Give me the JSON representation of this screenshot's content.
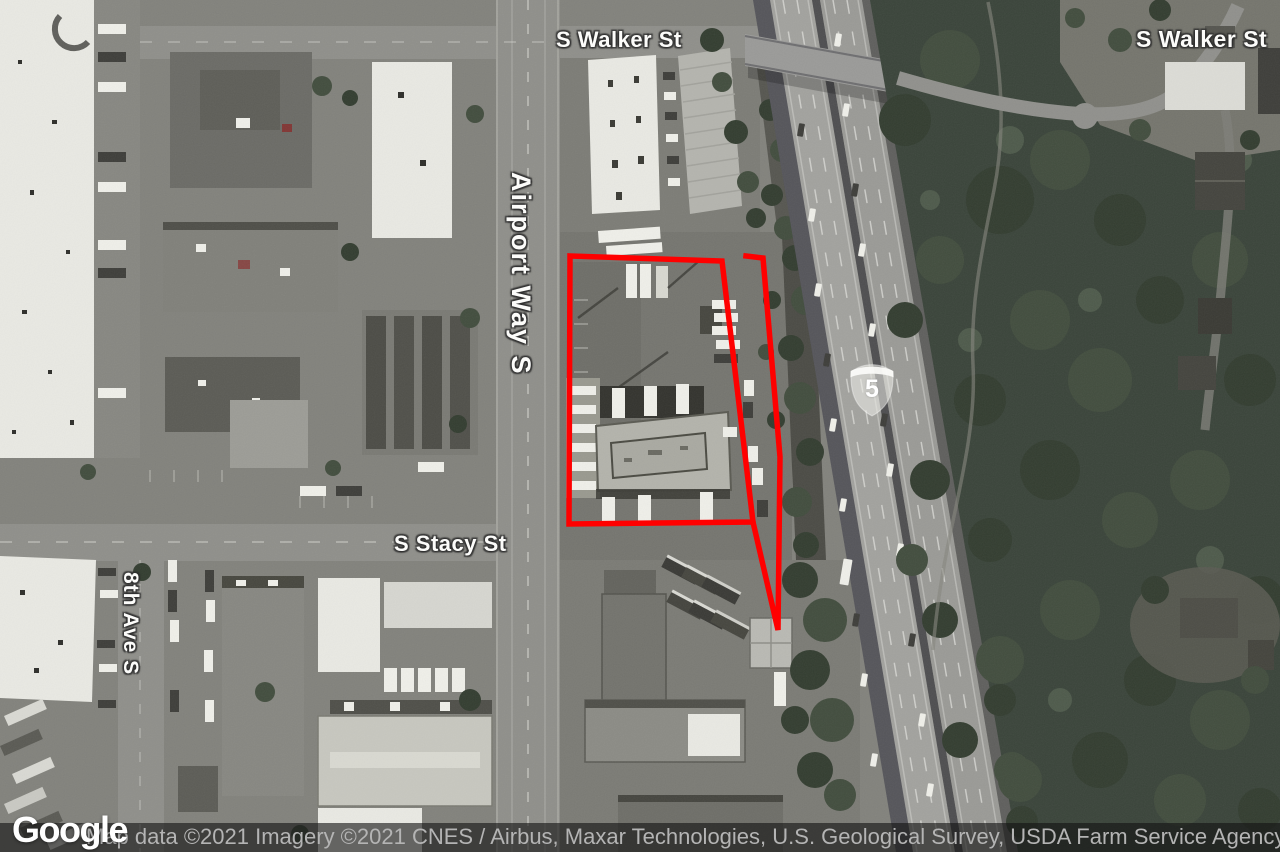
{
  "map": {
    "road_labels": {
      "walker_west": "S Walker St",
      "walker_east": "S Walker St",
      "airport_way": "Airport Way S",
      "stacy": "S Stacy St",
      "eighth_ave": "8th Ave S"
    },
    "highway_shield": {
      "route_number": "5"
    },
    "parcel_outline": {
      "color": "#ff0000",
      "main_polygon_points": "570,256 722,261 753,522 569,524",
      "east_strip_path": "M746,256 L763,258 L780,457 L778,630 L753,522"
    },
    "colors": {
      "outline_red": "#ff0000",
      "forest_green": "#3a443a",
      "road_gray": "#8f8f8a",
      "attribution_bg": "rgba(20,20,20,0.62)"
    },
    "footer": {
      "logo": "Google",
      "attribution": "Map data ©2021 Imagery ©2021 CNES / Airbus, Maxar Technologies, U.S. Geological Survey, USDA Farm Service Agency"
    }
  }
}
